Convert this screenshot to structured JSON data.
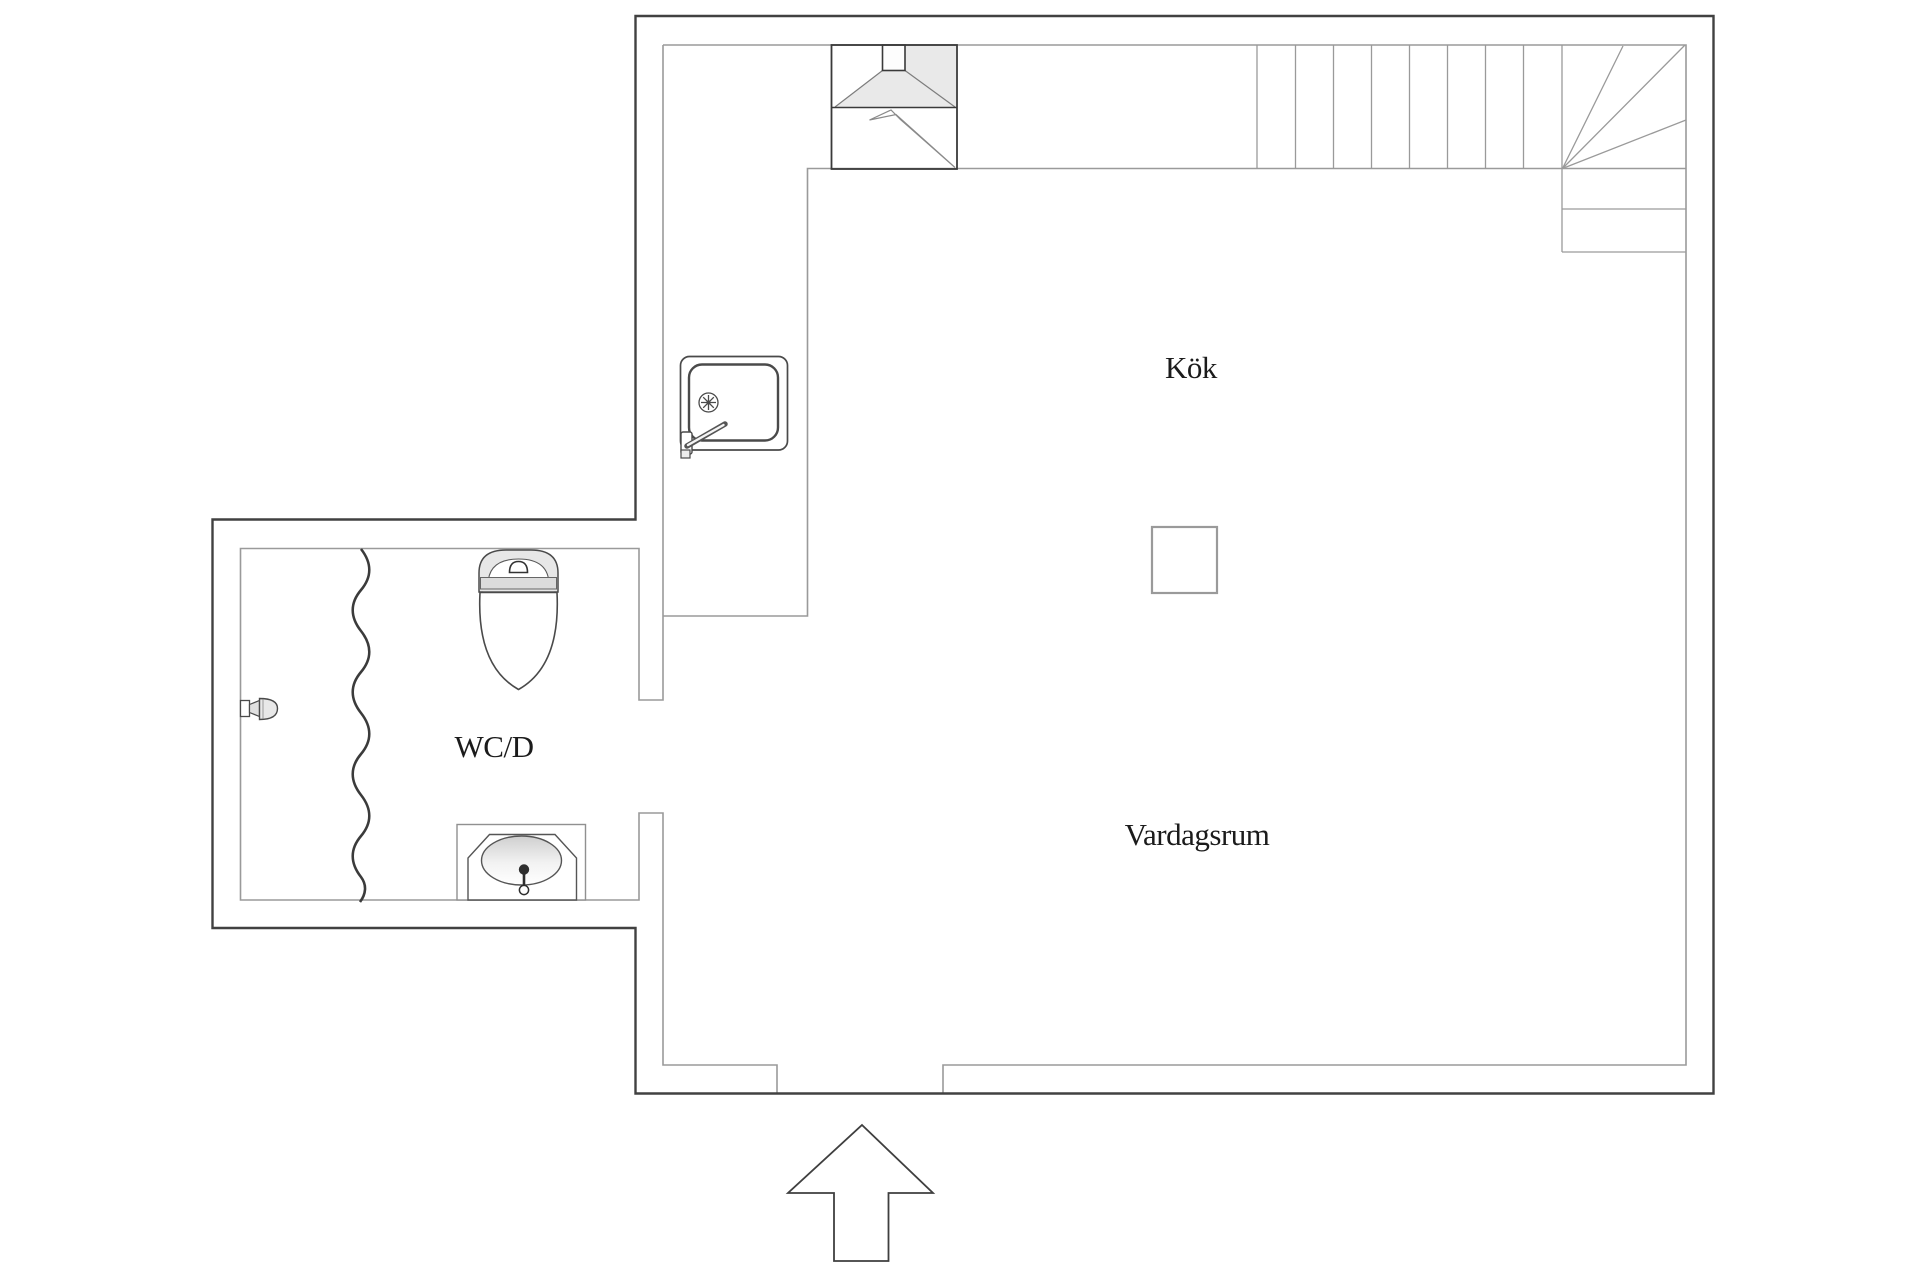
{
  "floorplan": {
    "rooms": [
      {
        "id": "kok",
        "label": "Kök"
      },
      {
        "id": "vardagsrum",
        "label": "Vardagsrum"
      },
      {
        "id": "wcd",
        "label": "WC/D"
      }
    ],
    "fixtures": {
      "kitchen": [
        "cooktop-hood-icon",
        "lightning-stove-icon",
        "kitchen-sink-icon",
        "chimney-pillar-icon"
      ],
      "bathroom": [
        "toilet-icon",
        "washbasin-icon",
        "shower-head-icon",
        "shower-curtain-icon"
      ],
      "circulation": [
        "staircase-with-winder-icon",
        "entry-arrow-icon"
      ]
    },
    "colors": {
      "background": "#ffffff",
      "wall_outer": "#414141",
      "wall_inner": "#9a9a9a",
      "fixture_light_fill": "#e9e9e9",
      "shade_fill": "#dcdcdc",
      "label_text": "#1b1b1b"
    }
  }
}
